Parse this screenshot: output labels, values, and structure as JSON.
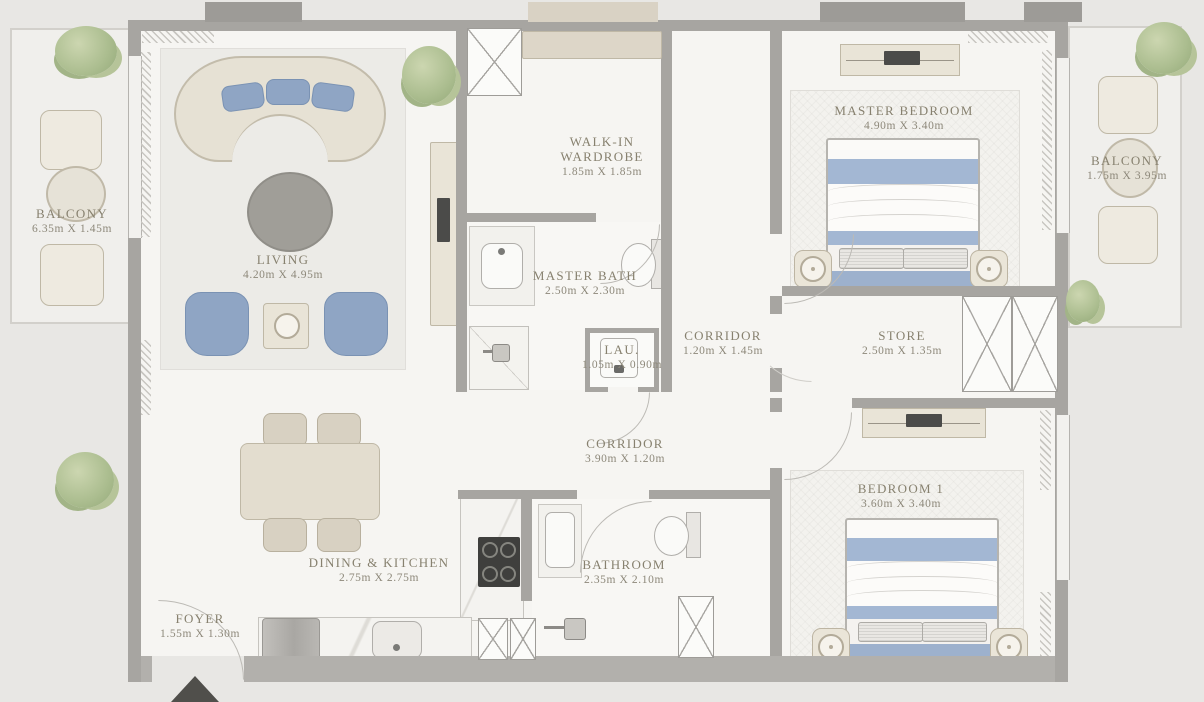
{
  "rooms": [
    {
      "id": "balcony-left",
      "name": "BALCONY",
      "dims": "6.35m X 1.45m"
    },
    {
      "id": "living",
      "name": "LIVING",
      "dims": "4.20m X 4.95m"
    },
    {
      "id": "walk-in-wardrobe",
      "name": "WALK-IN WARDROBE",
      "dims": "1.85m X 1.85m"
    },
    {
      "id": "master-bath",
      "name": "MASTER BATH",
      "dims": "2.50m X 2.30m"
    },
    {
      "id": "laundry",
      "name": "LAU.",
      "dims": "1.05m X 0.90m"
    },
    {
      "id": "corridor-upper",
      "name": "CORRIDOR",
      "dims": "1.20m X 1.45m"
    },
    {
      "id": "master-bedroom",
      "name": "MASTER BEDROOM",
      "dims": "4.90m X 3.40m"
    },
    {
      "id": "store",
      "name": "STORE",
      "dims": "2.50m X 1.35m"
    },
    {
      "id": "balcony-right",
      "name": "BALCONY",
      "dims": "1.75m X 3.95m"
    },
    {
      "id": "corridor-lower",
      "name": "CORRIDOR",
      "dims": "3.90m X 1.20m"
    },
    {
      "id": "bedroom-1",
      "name": "BEDROOM 1",
      "dims": "3.60m X 3.40m"
    },
    {
      "id": "dining-kitchen",
      "name": "DINING & KITCHEN",
      "dims": "2.75m X 2.75m"
    },
    {
      "id": "bathroom",
      "name": "BATHROOM",
      "dims": "2.35m X 2.10m"
    },
    {
      "id": "foyer",
      "name": "FOYER",
      "dims": "1.55m X 1.30m"
    }
  ],
  "colors": {
    "wall": "#a7a5a1",
    "label_text": "#87816f",
    "accent_blue": "#8fa5c4",
    "furniture_cream": "#e9e4d7",
    "plant_green": "#abbd8f"
  },
  "icons": {
    "entrance": "entrance-arrow",
    "shaft": "duct-cross"
  }
}
